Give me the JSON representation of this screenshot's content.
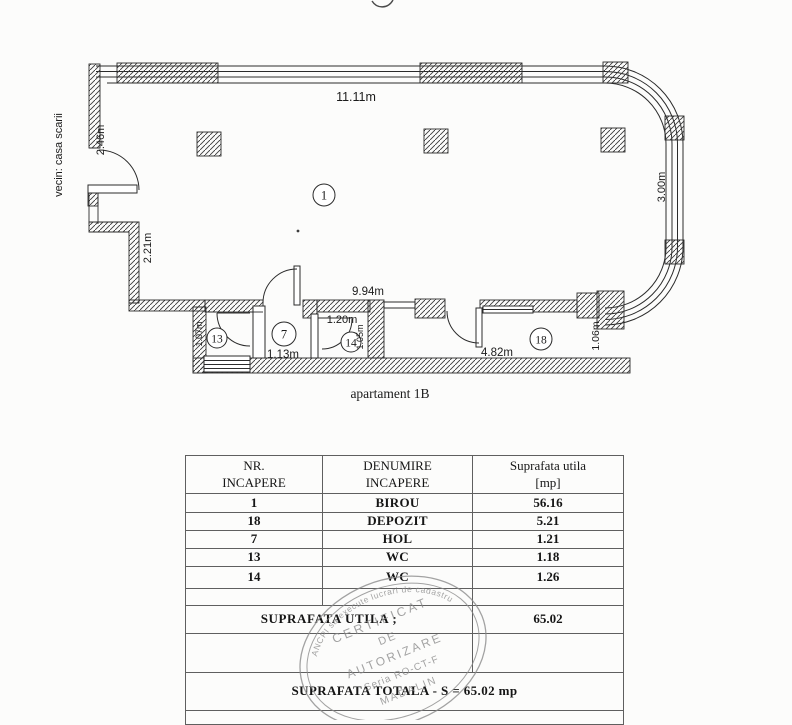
{
  "colors": {
    "ink": "#1b1b1b",
    "wall_line": "#2b2b2b",
    "table_border": "#5f5f5f",
    "stamp_gray": "#8a8a8a",
    "background": "#fcfcfb"
  },
  "plan": {
    "caption": "apartament 1B",
    "neighbor_label": "vecin: casa scarii",
    "room_markers": [
      {
        "number": "1"
      },
      {
        "number": "7"
      },
      {
        "number": "13"
      },
      {
        "number": "14"
      },
      {
        "number": "18"
      }
    ],
    "dimensions": [
      {
        "text": "11.11m"
      },
      {
        "text": "2.46m"
      },
      {
        "text": "2.21m"
      },
      {
        "text": "9.94m"
      },
      {
        "text": "1.20m"
      },
      {
        "text": "1.13m"
      },
      {
        "text": "1.07m"
      },
      {
        "text": "1.05m"
      },
      {
        "text": "4.82m"
      },
      {
        "text": "1.06m"
      },
      {
        "text": "3.00m"
      }
    ]
  },
  "table": {
    "headers": [
      {
        "line1": "NR.",
        "line2": "INCAPERE"
      },
      {
        "line1": "DENUMIRE",
        "line2": "INCAPERE"
      },
      {
        "line1": "Suprafata utila",
        "line2": "[mp]"
      }
    ],
    "rows": [
      {
        "nr": "1",
        "name": "BIROU",
        "area": "56.16"
      },
      {
        "nr": "18",
        "name": "DEPOZIT",
        "area": "5.21"
      },
      {
        "nr": "7",
        "name": "HOL",
        "area": "1.21"
      },
      {
        "nr": "13",
        "name": "WC",
        "area": "1.18"
      },
      {
        "nr": "14",
        "name": "WC",
        "area": "1.26"
      }
    ],
    "subtotal_label": "SUPRAFATA UTILA ;",
    "subtotal_value": "65.02",
    "total_label": "SUPRAFATA TOTALA - S = 65.02 mp"
  },
  "stamp": {
    "rim_text": "ANCPI sa execute lucrari de cadastru",
    "line1": "CERTIFICAT",
    "line2": "DE",
    "line3": "AUTORIZARE",
    "line4": "Seria RO-CT-F",
    "line5": "MADALIN"
  }
}
